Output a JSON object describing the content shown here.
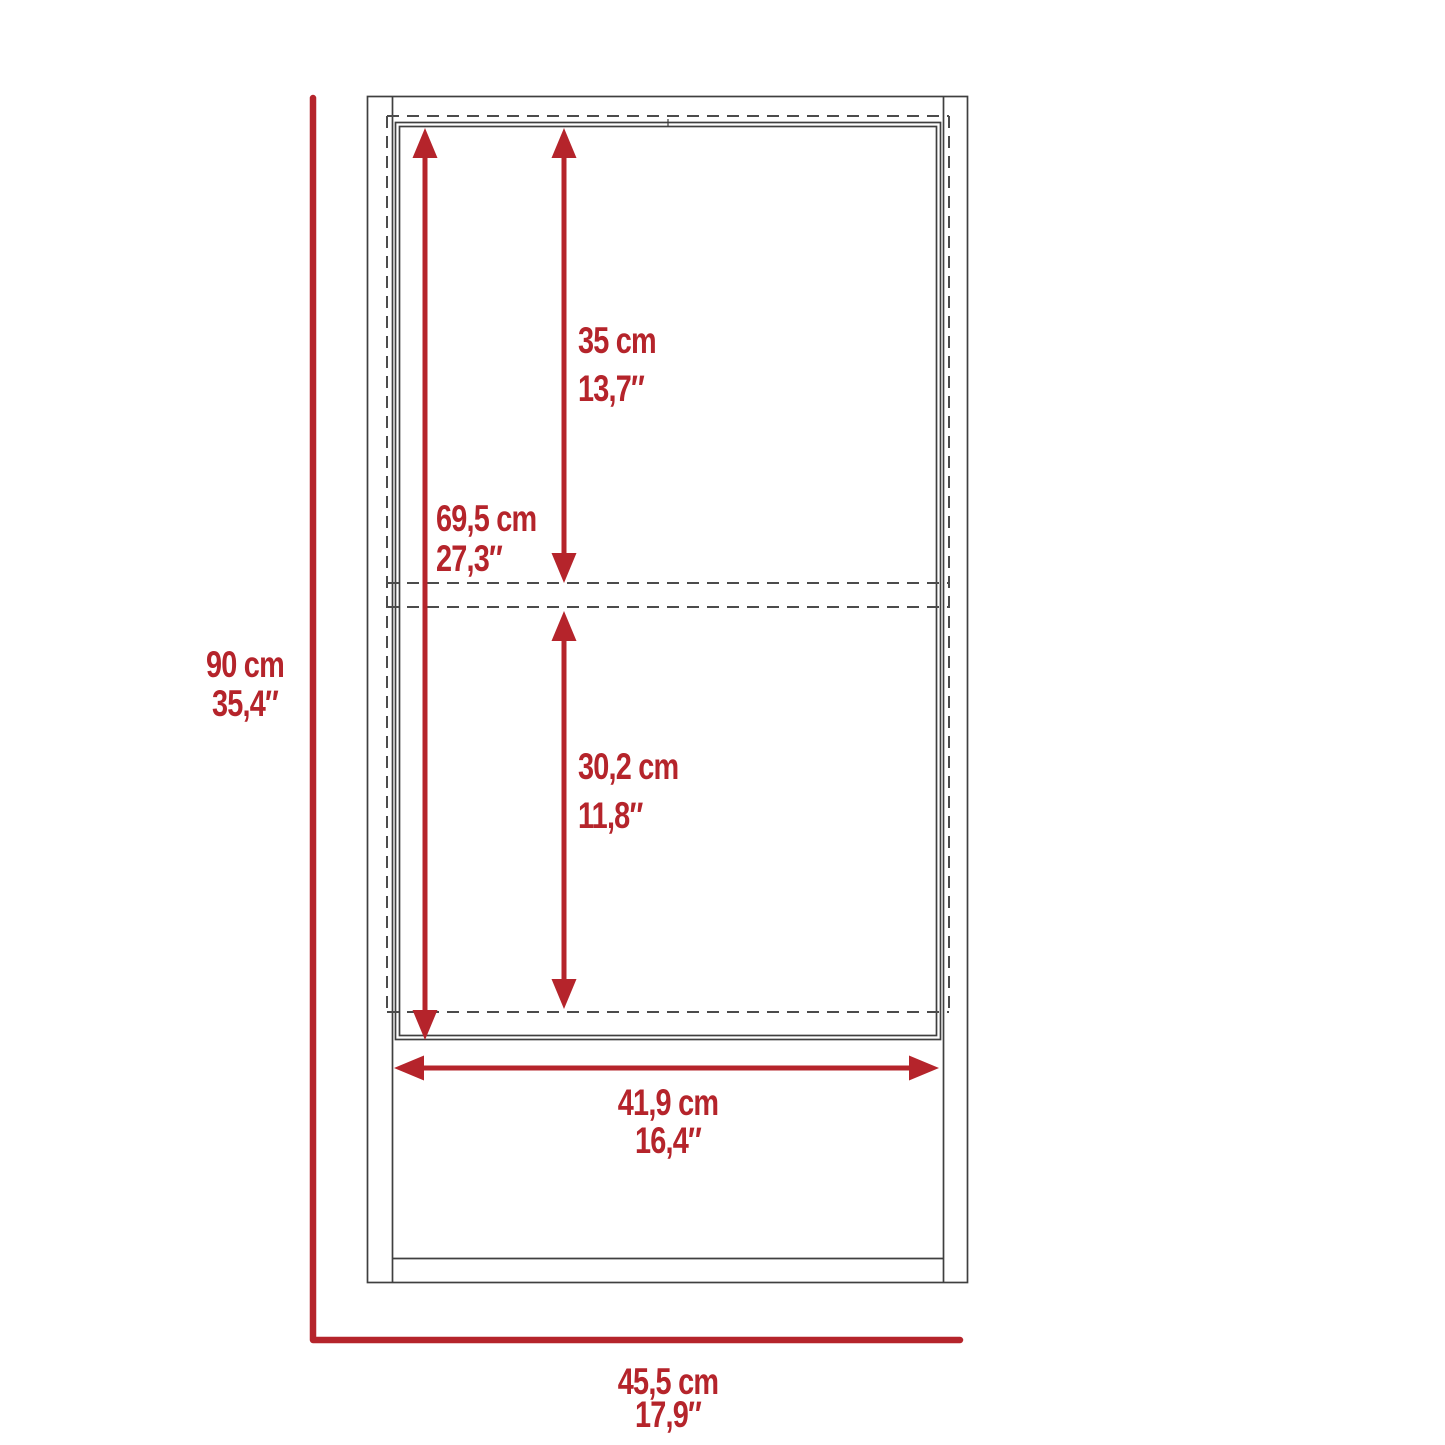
{
  "diagram": {
    "type": "furniture-dimension-drawing",
    "subject": "wall-cabinet-front-elevation",
    "accent_color": "#b5242b",
    "line_color": "#3f3f3f",
    "dashed_line_color": "#4c4c4c",
    "dimensions": {
      "overall_height": {
        "cm": "90 cm",
        "in": "35,4″"
      },
      "overall_width": {
        "cm": "45,5 cm",
        "in": "17,9″"
      },
      "door_height": {
        "cm": "69,5 cm",
        "in": "27,3″"
      },
      "upper_section_height": {
        "cm": "35 cm",
        "in": "13,7″"
      },
      "lower_section_height": {
        "cm": "30,2 cm",
        "in": "11,8″"
      },
      "inner_width": {
        "cm": "41,9 cm",
        "in": "16,4″"
      }
    }
  }
}
